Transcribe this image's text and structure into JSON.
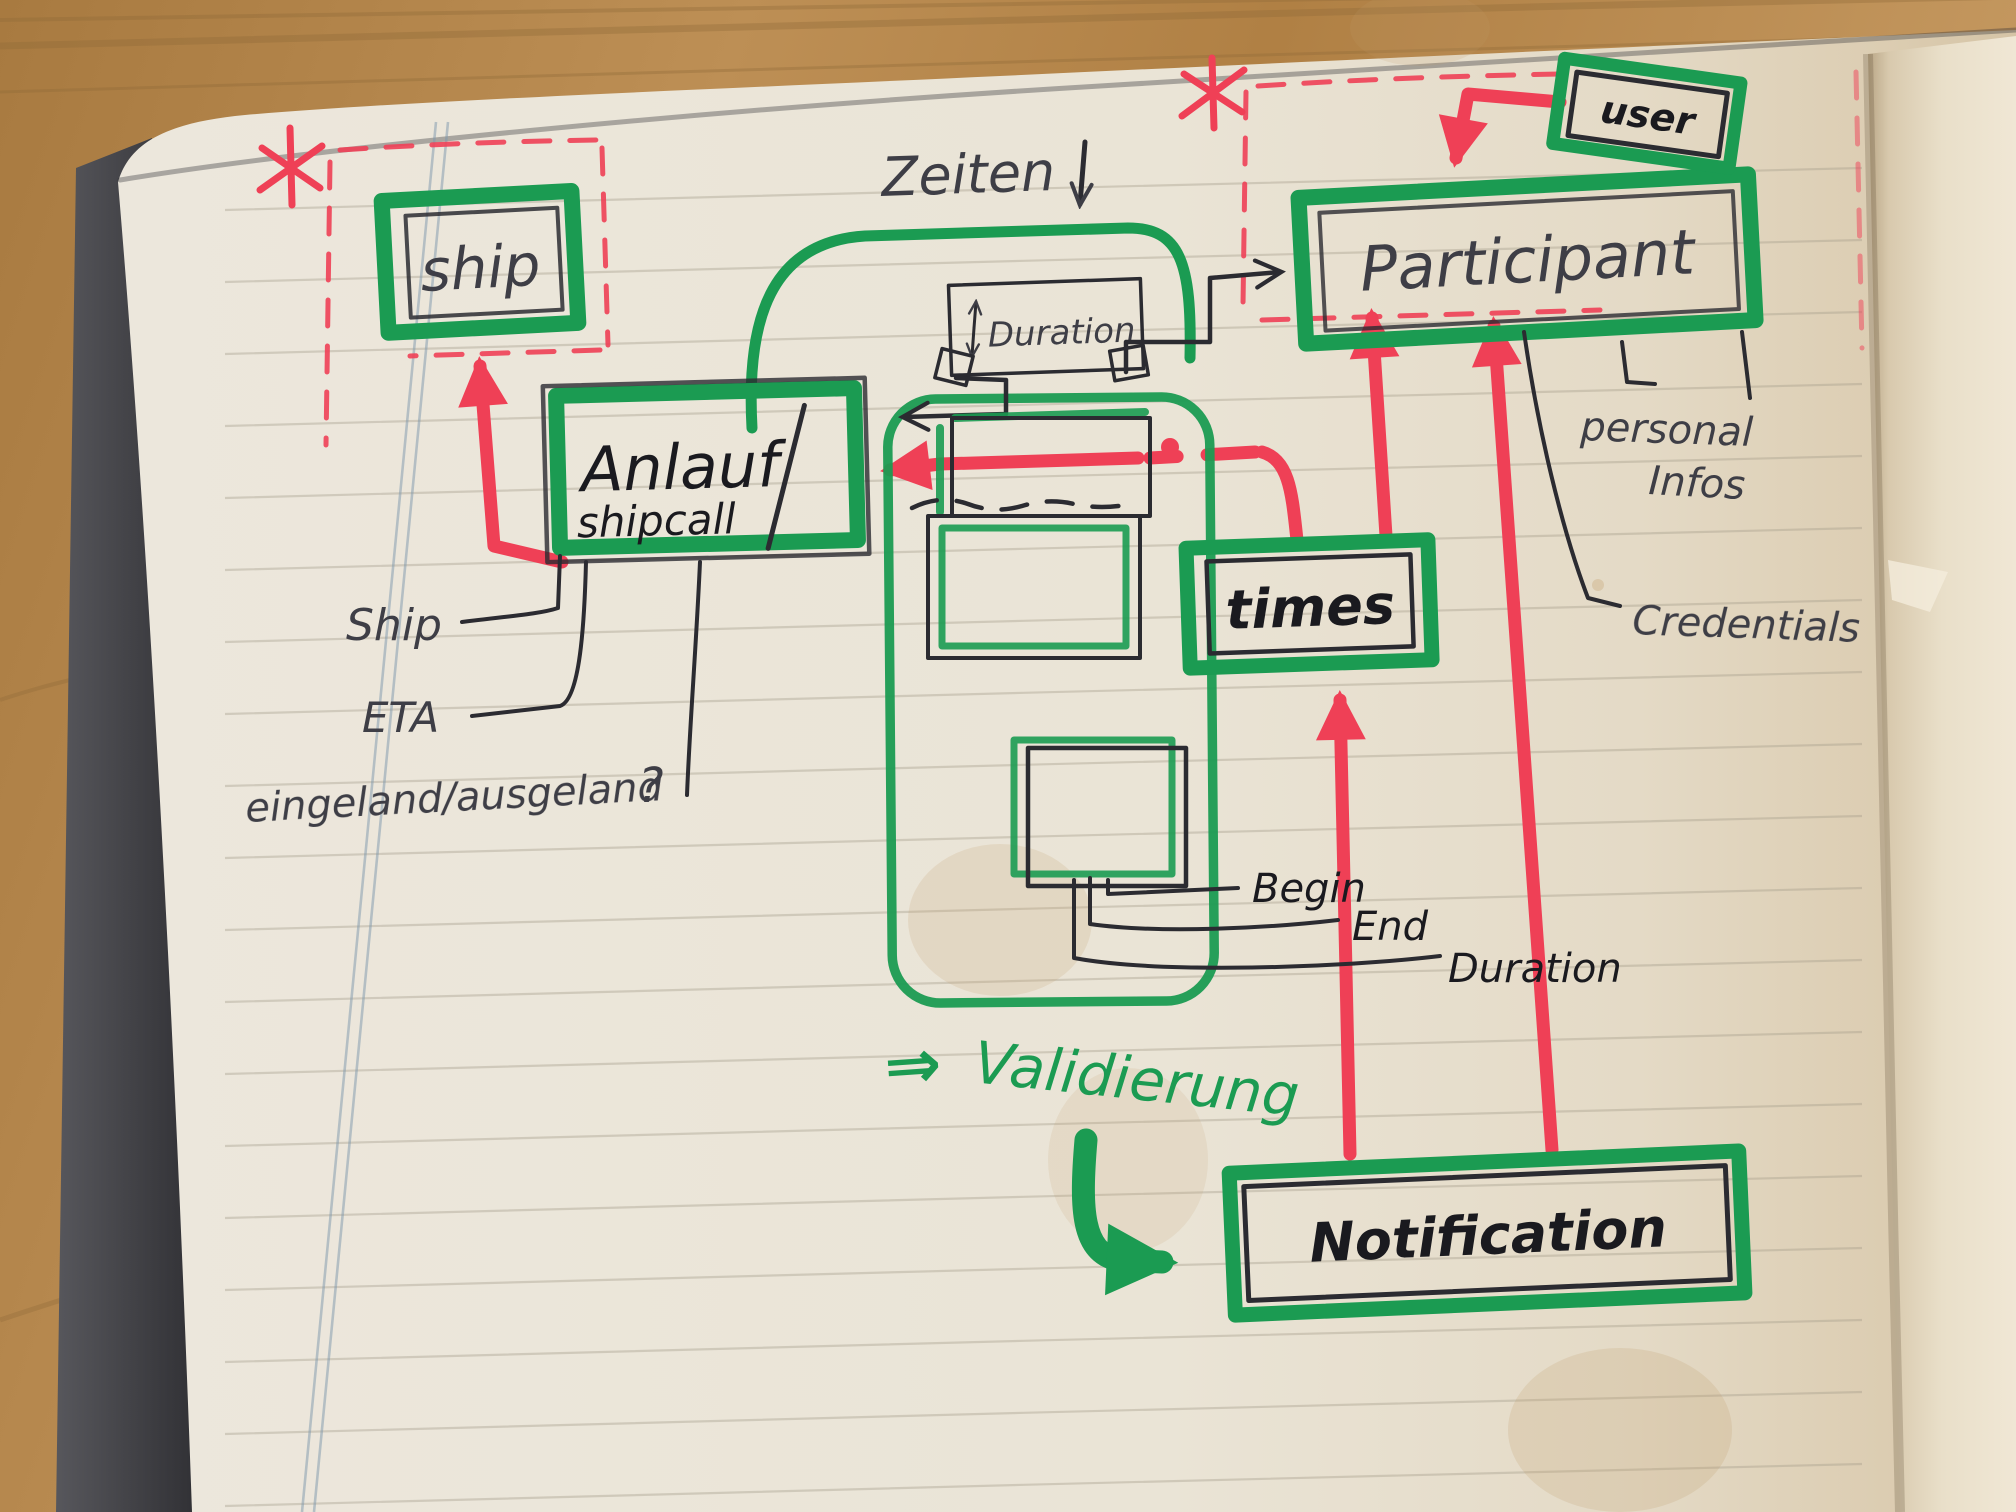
{
  "scene": {
    "description": "Hand-drawn entity data-model sketch in a paper notebook on a wooden table",
    "medium": "notebook-photo"
  },
  "colors": {
    "marker_green": "#1b9b52",
    "marker_red": "#ef4056",
    "ink_black": "#2b2b31",
    "pencil_gray": "#3e3e46",
    "paper": "#eae4d6",
    "wood": "#b58548"
  },
  "boxes": {
    "ship": "ship",
    "anlauf_title": "Anlauf",
    "anlauf_slash": "/",
    "anlauf_sub": "shipcall",
    "duration": "Duration",
    "participant": "Participant",
    "user": "user",
    "times": "times",
    "notification": "Notification"
  },
  "labels": {
    "zeiten": "Zeiten",
    "ship_attr": "Ship",
    "eta": "ETA",
    "inout": "eingeland/ausgeland",
    "question": "?",
    "begin": "Begin",
    "end": "End",
    "duration_attr": "Duration",
    "personal1": "personal",
    "personal2": "Infos",
    "credentials": "Credentials",
    "validierung_arrow": "⇒",
    "validierung": "Validierung",
    "asterisk_left": "*",
    "asterisk_right": "*"
  }
}
